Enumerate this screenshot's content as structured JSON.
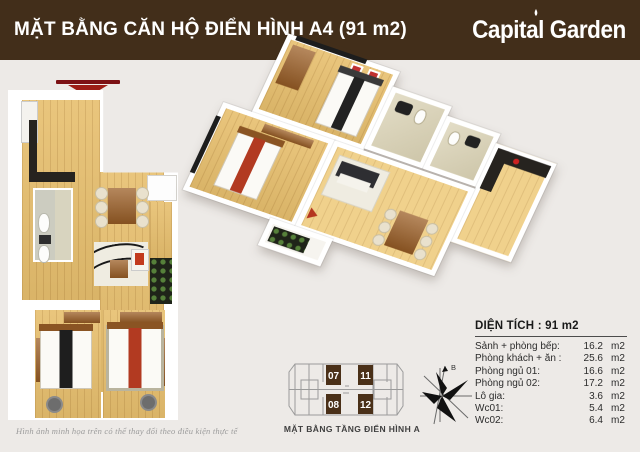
{
  "header": {
    "title": "MẶT BẰNG CĂN HỘ ĐIỂN HÌNH A4  (91 m2)",
    "brand": "Capital Garden"
  },
  "colors": {
    "header_bg": "#422e1a",
    "accent_red": "#9d1d16",
    "unit_block_brown": "#4a3018",
    "background": "#edeae7"
  },
  "area_table": {
    "title": "DIỆN TÍCH :  91 m2",
    "rows": [
      {
        "label": "Sảnh + phòng bếp:",
        "value": "16.2",
        "unit": "m2"
      },
      {
        "label": "Phòng khách + ăn :",
        "value": "25.6",
        "unit": "m2"
      },
      {
        "label": "Phòng ngủ 01:",
        "value": "16.6",
        "unit": "m2"
      },
      {
        "label": "Phòng ngủ 02:",
        "value": "17.2",
        "unit": "m2"
      },
      {
        "label": "Lô gia:",
        "value": "3.6",
        "unit": "m2"
      },
      {
        "label": "Wc01:",
        "value": "5.4",
        "unit": "m2"
      },
      {
        "label": "Wc02:",
        "value": "6.4",
        "unit": "m2"
      }
    ]
  },
  "key_plan": {
    "caption": "MẶT BẰNG TẦNG ĐIỂN HÌNH A",
    "units": [
      "07",
      "11",
      "08",
      "12"
    ]
  },
  "compass": {
    "north_label": "B"
  },
  "disclaimer": "Hình ảnh minh họa trên có thể thay đổi theo điều kiện thực tế"
}
